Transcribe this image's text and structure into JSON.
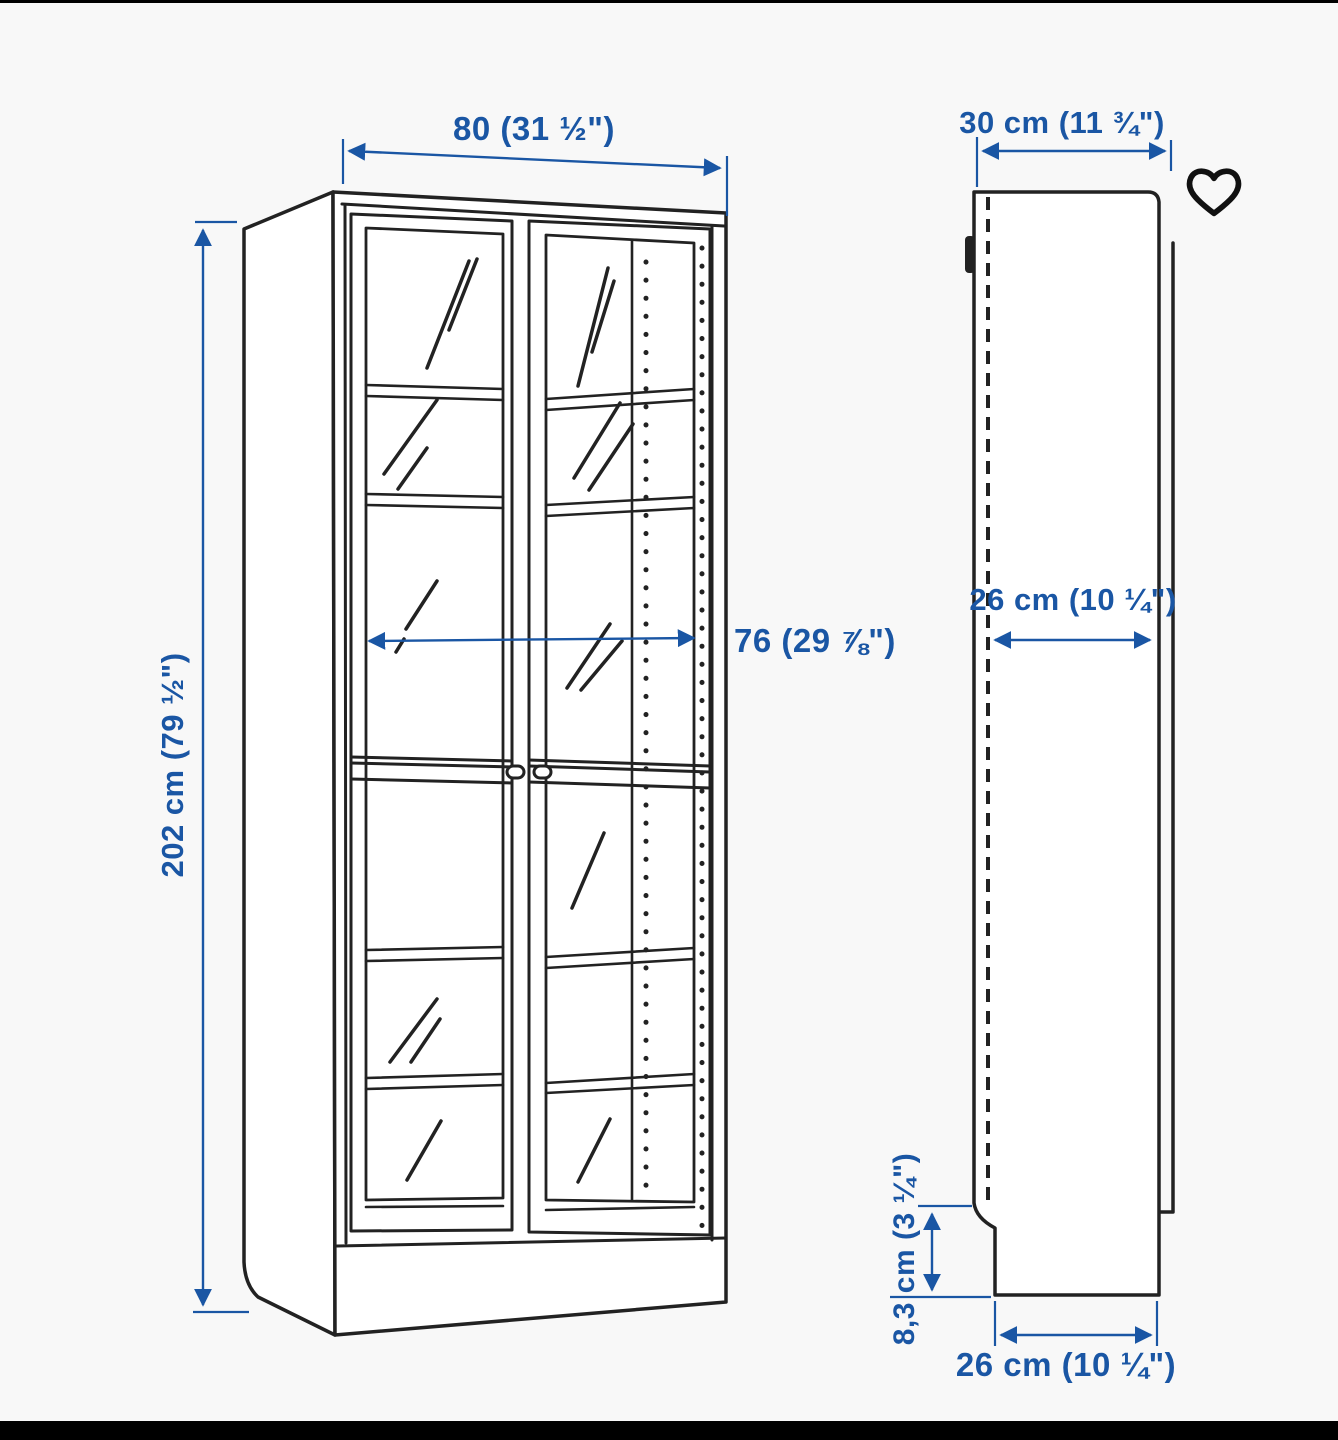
{
  "colors": {
    "accent": "#1a56a4",
    "line": "#222222",
    "background": "#f8f8f8",
    "letterbox": "#000000",
    "heart": "#111111"
  },
  "favorite": {
    "icon": "heart-outline",
    "filled": false
  },
  "annotations": {
    "front_width": "80 (31 ½\")",
    "front_height": "202 cm (79 ½\")",
    "front_inner_width": "76 (29 ⅞\")",
    "side_depth": "30 cm (11 ¾\")",
    "side_inner_depth": "26 cm (10 ¼\")",
    "plinth_height": "8,3 cm (3 ¼\")",
    "side_bottom_depth": "26 cm (10 ¼\")"
  }
}
